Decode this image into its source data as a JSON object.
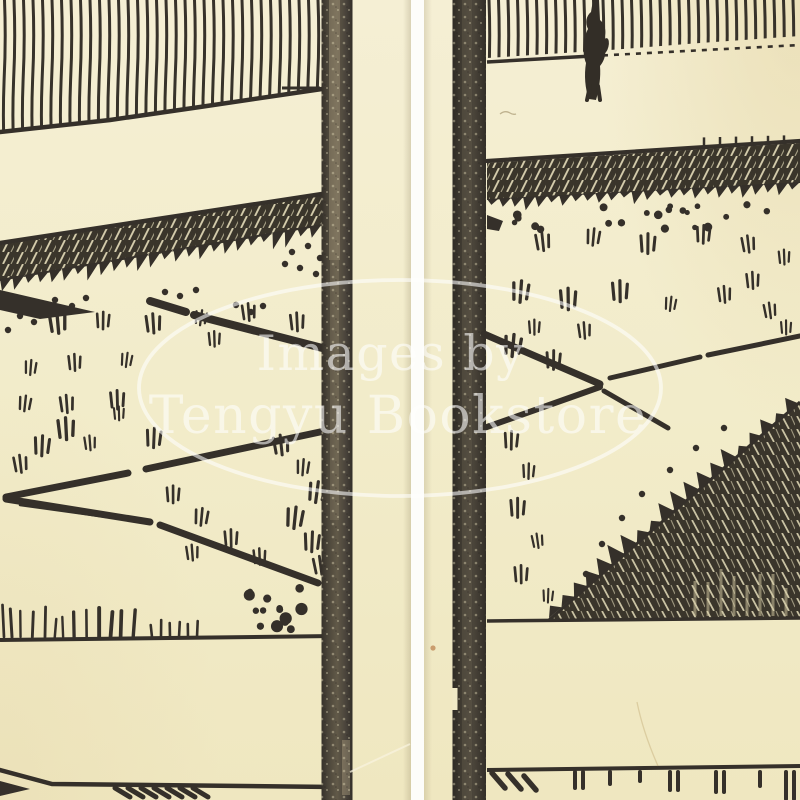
{
  "scene": {
    "description": "Scan of an antique woodblock-printed book: two facing page fragments with landscape engraving, separated by a white gutter",
    "page_count": "2"
  },
  "watermark": {
    "line1": "Images by",
    "line2": "Tengyu Bookstore",
    "text_color": "#ffffff",
    "opacity": "0.58",
    "shape": "ellipse-outline"
  },
  "colors": {
    "paper": "#f2ecca",
    "paper_light": "#f6f1d8",
    "paper_dark": "#ece2ba",
    "ink": "#35302a",
    "bar_left": "#564f3f",
    "bar_right": "#3e3931",
    "gutter": "#ffffff",
    "stain": "#b06a35",
    "scratch": "#b69a60"
  }
}
